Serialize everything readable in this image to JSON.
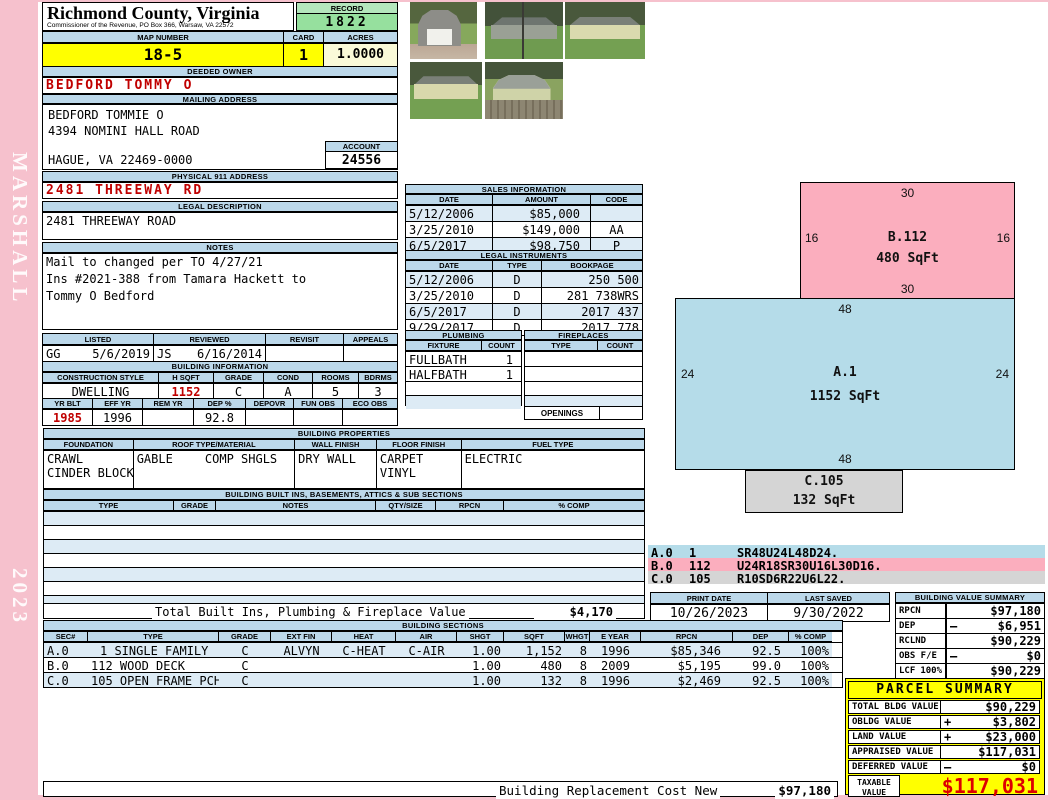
{
  "sidebar": {
    "company": "MARSHALL",
    "year": "2023"
  },
  "header": {
    "county": "Richmond County, Virginia",
    "commissioner": "Commissioner of the Revenue, PO Box 366, Warsaw, VA 22572",
    "record_label": "RECORD",
    "record": "1822",
    "map_label": "MAP NUMBER",
    "map_number": "18-5",
    "card_label": "CARD",
    "card": "1",
    "acres_label": "ACRES",
    "acres": "1.0000"
  },
  "owner": {
    "deeded_label": "DEEDED OWNER",
    "deeded": "BEDFORD TOMMY O",
    "mailing_label": "MAILING ADDRESS",
    "mail_name": "BEDFORD TOMMIE O",
    "mail_street": "4394 NOMINI HALL ROAD",
    "mail_city": "HAGUE, VA 22469-0000",
    "account_label": "ACCOUNT",
    "account": "24556"
  },
  "location": {
    "physical_label": "PHYSICAL 911 ADDRESS",
    "physical": "2481 THREEWAY RD",
    "legal_label": "LEGAL DESCRIPTION",
    "legal": "2481 THREEWAY ROAD"
  },
  "notes": {
    "label": "NOTES",
    "line1": "Mail to changed per TO 4/27/21",
    "line2": "Ins #2021-388 from Tamara Hackett to",
    "line3": "Tommy O Bedford"
  },
  "review": {
    "listed_label": "LISTED",
    "reviewed_label": "REVIEWED",
    "revisit_label": "REVISIT",
    "appeals_label": "APPEALS",
    "listed_by": "GG",
    "listed_date": "5/6/2019",
    "reviewed_by": "JS",
    "reviewed_date": "6/16/2014",
    "revisit": "",
    "appeals": ""
  },
  "building_info": {
    "title": "BUILDING INFORMATION",
    "style_label": "CONSTRUCTION STYLE",
    "style": "DWELLING",
    "hsqft_label": "H SQFT",
    "hsqft": "1152",
    "grade_label": "GRADE",
    "grade": "C",
    "cond_label": "COND",
    "cond": "A",
    "rooms_label": "ROOMS",
    "rooms": "5",
    "bdrms_label": "BDRMS",
    "bdrms": "3",
    "yrblt_label": "YR BLT",
    "yrblt": "1985",
    "effyr_label": "EFF YR",
    "effyr": "1996",
    "remyr_label": "REM YR",
    "remyr": "",
    "dep_label": "DEP %",
    "dep": "92.8",
    "depovr_label": "DEPOVR",
    "depovr": "",
    "funobs_label": "FUN OBS",
    "funobs": "",
    "ecoobs_label": "ECO OBS",
    "ecoobs": ""
  },
  "building_properties": {
    "title": "BUILDING PROPERTIES",
    "foundation_label": "FOUNDATION",
    "foundation1": "CRAWL",
    "foundation2": "CINDER BLOCK",
    "roof_label": "ROOF TYPE/MATERIAL",
    "roof_type": "GABLE",
    "roof_material": "COMP SHGLS",
    "wall_label": "WALL FINISH",
    "wall": "DRY WALL",
    "floor_label": "FLOOR FINISH",
    "floor1": "CARPET",
    "floor2": "VINYL",
    "fuel_label": "FUEL TYPE",
    "fuel": "ELECTRIC"
  },
  "built_ins": {
    "title": "BUILDING BUILT INS, BASEMENTS, ATTICS & SUB SECTIONS",
    "headers": [
      "TYPE",
      "GRADE",
      "NOTES",
      "QTY/SIZE",
      "RPCN",
      "% COMP"
    ],
    "total_label": "Total Built Ins, Plumbing & Fireplace Value",
    "total": "$4,170"
  },
  "sales": {
    "title": "SALES INFORMATION",
    "headers": [
      "DATE",
      "AMOUNT",
      "CODE"
    ],
    "rows": [
      {
        "date": "5/12/2006",
        "amount": "$85,000",
        "code": ""
      },
      {
        "date": "3/25/2010",
        "amount": "$149,000",
        "code": "AA"
      },
      {
        "date": "6/5/2017",
        "amount": "$98,750",
        "code": "P"
      }
    ]
  },
  "instruments": {
    "title": "LEGAL INSTRUMENTS",
    "headers": [
      "DATE",
      "TYPE",
      "BOOKPAGE"
    ],
    "rows": [
      {
        "date": "5/12/2006",
        "type": "D",
        "bookpage": "250 500"
      },
      {
        "date": "3/25/2010",
        "type": "D",
        "bookpage": "281 738WRS"
      },
      {
        "date": "6/5/2017",
        "type": "D",
        "bookpage": "2017 437"
      },
      {
        "date": "9/29/2017",
        "type": "D",
        "bookpage": "2017 778"
      }
    ]
  },
  "plumbing": {
    "title": "PLUMBING",
    "fixture_label": "FIXTURE",
    "count_label": "COUNT",
    "rows": [
      {
        "fixture": "FULLBATH",
        "count": "1"
      },
      {
        "fixture": "HALFBATH",
        "count": "1"
      }
    ]
  },
  "fireplaces": {
    "title": "FIREPLACES",
    "type_label": "TYPE",
    "count_label": "COUNT",
    "openings_label": "OPENINGS"
  },
  "sketch": {
    "shapes": [
      {
        "id": "B.112",
        "sqft": "480 SqFt",
        "top": "30",
        "bottom": "30",
        "left": "16",
        "right": "16"
      },
      {
        "id": "A.1",
        "sqft": "1152 SqFt",
        "top": "48",
        "bottom": "48",
        "left": "24",
        "right": "24"
      },
      {
        "id": "C.105",
        "sqft": "132 SqFt"
      }
    ],
    "legend": [
      {
        "sec": "A.0",
        "code": "1",
        "path": "SR48U24L48D24."
      },
      {
        "sec": "B.0",
        "code": "112",
        "path": "U24R18SR30U16L30D16."
      },
      {
        "sec": "C.0",
        "code": "105",
        "path": "R10SD6R22U6L22."
      }
    ]
  },
  "print_info": {
    "print_label": "PRINT DATE",
    "print_date": "10/26/2023",
    "saved_label": "LAST SAVED",
    "saved_date": "9/30/2022"
  },
  "value_summary": {
    "title": "BUILDING VALUE SUMMARY",
    "rows": [
      {
        "label": "RPCN",
        "pct": "",
        "op": "",
        "value": "$97,180"
      },
      {
        "label": "DEP",
        "pct": "",
        "op": "–",
        "value": "$6,951"
      },
      {
        "label": "RCLND",
        "pct": "",
        "op": "",
        "value": "$90,229"
      },
      {
        "label": "OBS F/E",
        "pct": "",
        "op": "–",
        "value": "$0"
      },
      {
        "label": "LCF",
        "pct": "100%",
        "op": "",
        "value": "$90,229"
      }
    ]
  },
  "building_sections": {
    "title": "BUILDING SECTIONS",
    "headers": [
      "SEC#",
      "TYPE",
      "GRADE",
      "EXT FIN",
      "HEAT",
      "AIR",
      "SHGT",
      "SQFT",
      "WHGT",
      "E YEAR",
      "RPCN",
      "DEP",
      "% COMP"
    ],
    "rows": [
      {
        "sec": "A.0",
        "type": "1 SINGLE FAMILY",
        "grade": "C",
        "extfin": "ALVYN",
        "heat": "C-HEAT",
        "air": "C-AIR",
        "shgt": "1.00",
        "sqft": "1,152",
        "whgt": "8",
        "eyear": "1996",
        "rpcn": "$85,346",
        "dep": "92.5",
        "comp": "100%"
      },
      {
        "sec": "B.0",
        "type": "112 WOOD DECK",
        "grade": "C",
        "extfin": "",
        "heat": "",
        "air": "",
        "shgt": "1.00",
        "sqft": "480",
        "whgt": "8",
        "eyear": "2009",
        "rpcn": "$5,195",
        "dep": "99.0",
        "comp": "100%"
      },
      {
        "sec": "C.0",
        "type": "105 OPEN FRAME PCH",
        "grade": "C",
        "extfin": "",
        "heat": "",
        "air": "",
        "shgt": "1.00",
        "sqft": "132",
        "whgt": "8",
        "eyear": "1996",
        "rpcn": "$2,469",
        "dep": "92.5",
        "comp": "100%"
      }
    ]
  },
  "parcel_summary": {
    "title": "PARCEL SUMMARY",
    "rows": [
      {
        "label": "TOTAL BLDG VALUE",
        "op": "",
        "value": "$90,229"
      },
      {
        "label": "OBLDG VALUE",
        "op": "+",
        "value": "$3,802"
      },
      {
        "label": "LAND VALUE",
        "op": "+",
        "value": "$23,000"
      },
      {
        "label": "APPRAISED VALUE",
        "op": "",
        "value": "$117,031"
      },
      {
        "label": "DEFERRED VALUE",
        "op": "–",
        "value": "$0"
      }
    ],
    "taxable_label": "TAXABLE VALUE",
    "taxable": "$117,031"
  },
  "footer": {
    "label": "Building Replacement Cost New",
    "value": "$97,180"
  },
  "colors": {
    "page_pink": "#F6C1CD",
    "bar_blue": "#BCD8EA",
    "alt_blue": "#DDEBF5",
    "map_yellow": "#FFFF00",
    "acres_cream": "#FAFAD8",
    "record_green": "#96E09E",
    "accent_red": "#C00000",
    "sketch_pink": "#FBAEBE",
    "sketch_blue": "#B5DCE9",
    "sketch_gray": "#D5D5D5",
    "summary_yellow": "#FFFF00"
  }
}
